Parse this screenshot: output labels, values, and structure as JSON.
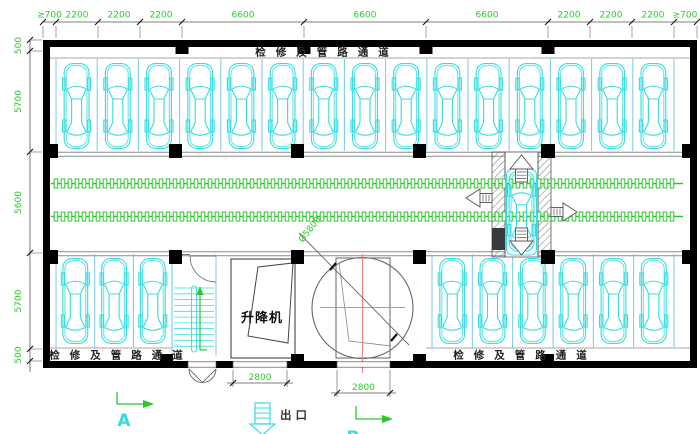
{
  "colors": {
    "line_green": "#2bc92b",
    "car_cyan": "#35dde0",
    "stall_blue": "#79c9ee",
    "wall": "#000000",
    "red_axis": "#f28080",
    "gray_line": "#8a8a8a",
    "text_dark": "#222222"
  },
  "dims_top": [
    "≥700",
    "2200",
    "2200",
    "2200",
    "6600",
    "6600",
    "6600",
    "2200",
    "2200",
    "2200",
    "≥700"
  ],
  "dims_left": [
    "500",
    "5700",
    "5600",
    "5700",
    "500"
  ],
  "dim_opening_left": "2800",
  "dim_opening_right": "2800",
  "dim_turntable": "Ø5800",
  "labels": {
    "corridor_top": "检修及管路通道",
    "corridor_bottom_left": "检修及管路通道",
    "corridor_bottom_right": "检修及管路通道",
    "lift_room": "升降机",
    "exit": "出口",
    "marker_a": "A",
    "marker_b": "B"
  },
  "stalls": {
    "top_count": 15,
    "bottom_left_count": 3,
    "bottom_right_count": 6
  }
}
